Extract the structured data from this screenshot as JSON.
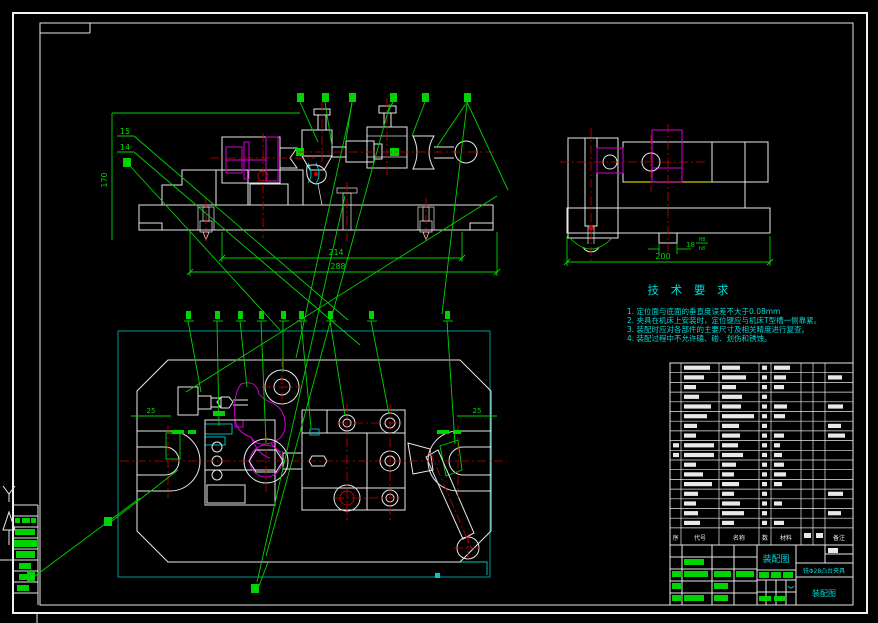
{
  "window": {
    "background": "#000000"
  },
  "views": {
    "front_view": {
      "dims": {
        "height": "170",
        "width_inner": "214",
        "width_outer": "288"
      },
      "callouts": {
        "upper": "15",
        "lower": "14"
      }
    },
    "side_view": {
      "dims": {
        "width": "200",
        "key_width": "18",
        "key_fit_num": "H8",
        "key_fit_den": "h8"
      }
    },
    "plan_view": {
      "dims": {
        "left_offset": "25",
        "right_offset": "25"
      }
    }
  },
  "tech_requirements": {
    "title": "技 术 要 求",
    "items": [
      "1. 定位面与底面的垂直度误差不大于0.08mm",
      "2. 夹具在机床上安装时，定位键应与机床T型槽一侧靠紧。",
      "3. 装配时应对各部件的主要尺寸及相关精度进行复查。",
      "4. 装配过程中不允许磕、碰、划伤和锈蚀。"
    ]
  },
  "bom": {
    "headers": [
      "序",
      "代号",
      "名称",
      "数",
      "材料",
      "备注"
    ],
    "rows": [
      [
        0,
        26,
        18,
        5,
        16,
        0,
        0,
        0
      ],
      [
        0,
        20,
        24,
        5,
        12,
        0,
        0,
        14
      ],
      [
        0,
        12,
        14,
        5,
        10,
        0,
        0,
        0
      ],
      [
        0,
        15,
        20,
        5,
        0,
        0,
        0,
        0
      ],
      [
        0,
        27,
        19,
        5,
        13,
        0,
        0,
        15
      ],
      [
        0,
        23,
        32,
        5,
        11,
        0,
        0,
        0
      ],
      [
        0,
        13,
        17,
        5,
        0,
        0,
        0,
        13
      ],
      [
        0,
        12,
        18,
        5,
        10,
        0,
        0,
        17
      ],
      [
        6,
        30,
        16,
        5,
        6,
        0,
        0,
        0
      ],
      [
        6,
        30,
        21,
        5,
        8,
        0,
        0,
        0
      ],
      [
        0,
        12,
        14,
        5,
        10,
        0,
        0,
        0
      ],
      [
        0,
        19,
        12,
        5,
        12,
        0,
        0,
        0
      ],
      [
        0,
        28,
        17,
        5,
        8,
        0,
        0,
        0
      ],
      [
        0,
        14,
        12,
        5,
        0,
        0,
        0,
        15
      ],
      [
        0,
        12,
        18,
        5,
        8,
        0,
        0,
        0
      ],
      [
        0,
        14,
        22,
        5,
        0,
        0,
        0,
        13
      ],
      [
        0,
        16,
        12,
        5,
        10,
        0,
        0,
        0
      ]
    ]
  },
  "title_block": {
    "drawing_type": "装配图",
    "product_name": "铣Φ28凸台夹具",
    "sheet_label": "装配图"
  },
  "colors": {
    "outline": "#e8e8e8",
    "dimension": "#00d400",
    "annotation": "#00d8d8",
    "component": "#d400d4",
    "centerline": "#cc0000",
    "aux_line": "#c8c800"
  }
}
